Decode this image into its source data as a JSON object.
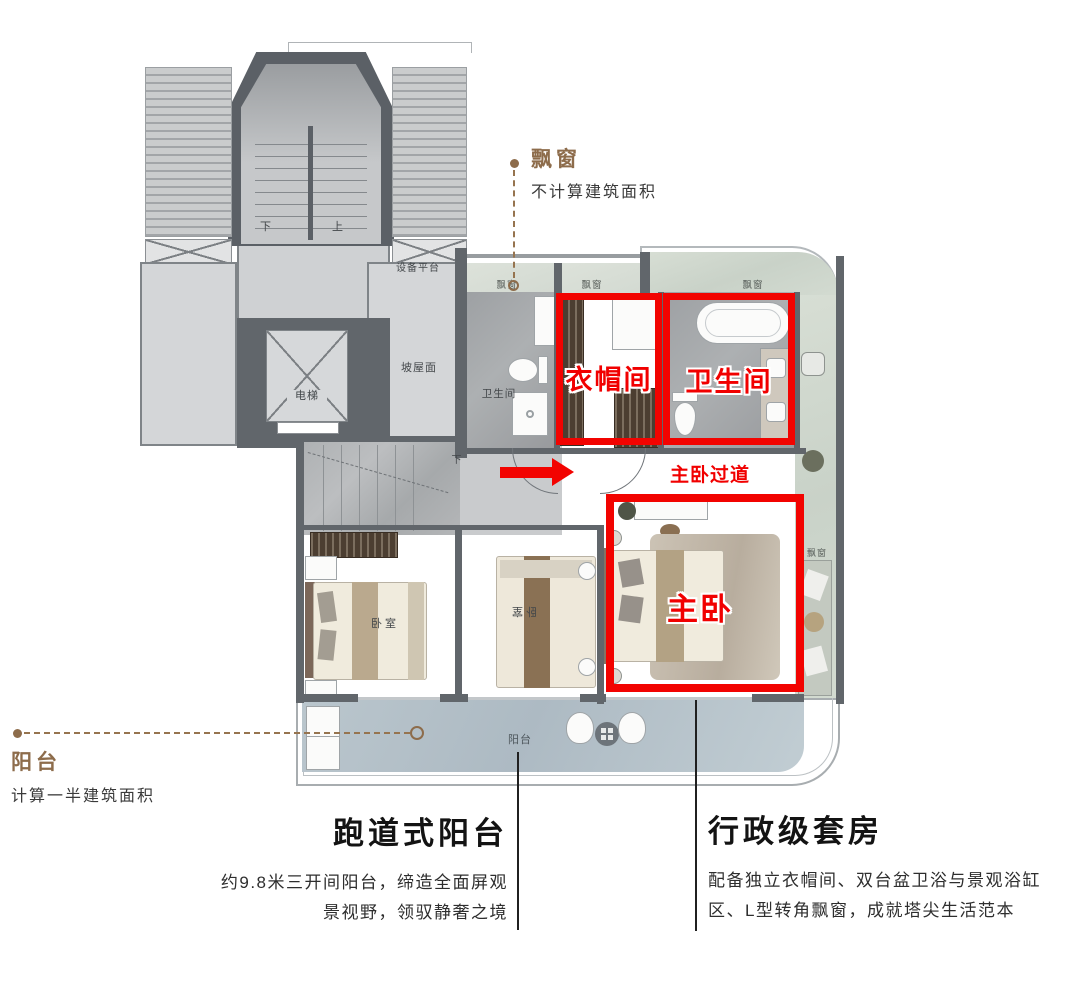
{
  "colors": {
    "highlight_red": "#f20300",
    "annotation_brown": "#8d6c4b",
    "wall_gray": "#61666b",
    "balcony_blue": "#b5c2ca"
  },
  "callouts": {
    "bay_window": {
      "title": "飘窗",
      "subtitle": "不计算建筑面积"
    },
    "balcony": {
      "title": "阳台",
      "subtitle": "计算一半建筑面积"
    }
  },
  "highlights": {
    "cloakroom": {
      "label": "衣帽间"
    },
    "master_bathroom": {
      "label": "卫生间"
    },
    "master_bedroom": {
      "label": "主卧"
    },
    "corridor": {
      "label": "主卧过道"
    }
  },
  "plan_labels": {
    "equipment_platform": "设备平台",
    "elevator": "电梯",
    "sloped_roof": "坡屋面",
    "bathroom": "卫生间",
    "bedroom": "卧室",
    "balcony": "阳台",
    "bay_window": "飘窗",
    "stair_up": "上",
    "stair_down": "下"
  },
  "features": {
    "left": {
      "title": "跑道式阳台",
      "lines": [
        "约9.8米三开间阳台，缔造全面屏观",
        "景视野，领驭静奢之境"
      ]
    },
    "right": {
      "title": "行政级套房",
      "lines": [
        "配备独立衣帽间、双台盆卫浴与景观浴缸",
        "区、L型转角飘窗，成就塔尖生活范本"
      ]
    }
  }
}
